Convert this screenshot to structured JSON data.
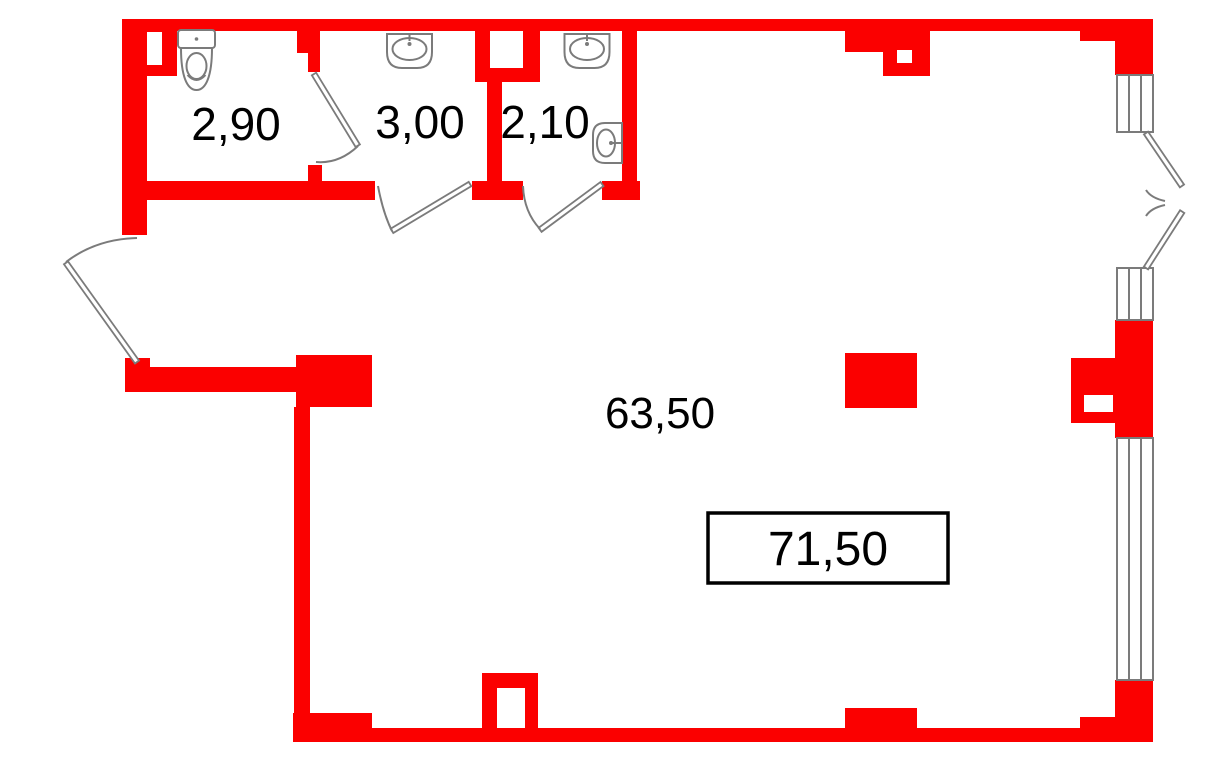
{
  "plan": {
    "kind": "apartment-floor-plan",
    "rooms": [
      {
        "name": "wc",
        "area": "2,90",
        "fixtures": [
          "toilet"
        ]
      },
      {
        "name": "bathroom",
        "area": "3,00",
        "fixtures": [
          "sink"
        ]
      },
      {
        "name": "shower-room",
        "area": "2,10",
        "fixtures": [
          "sink",
          "wall-basin"
        ]
      },
      {
        "name": "living-space",
        "area": "63,50",
        "fixtures": []
      },
      {
        "name": "total",
        "area": "71,50",
        "boxed": true,
        "fixtures": []
      }
    ],
    "openings": [
      "entry-door",
      "wc-door",
      "bathroom-door",
      "shower-room-door",
      "balcony-double-door",
      "window-top",
      "window-middle",
      "window-bottom"
    ]
  },
  "colors": {
    "wall": "#fb0000",
    "line": "#7b7b7b",
    "text": "#000000",
    "background": "#ffffff"
  }
}
